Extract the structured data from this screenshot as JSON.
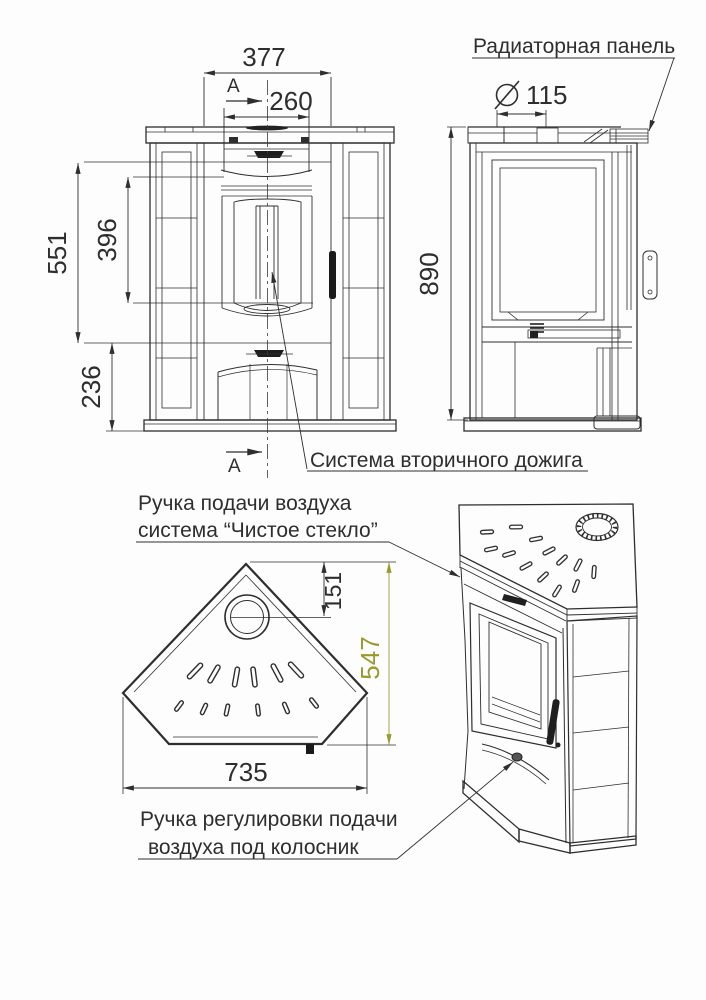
{
  "section_marker": "А",
  "front_view": {
    "dim_width_top": "377",
    "dim_width_opening": "260",
    "dim_height_upper": "551",
    "dim_height_glass": "396",
    "dim_height_lower": "236"
  },
  "side_view": {
    "dim_flue_diameter": "115",
    "dim_height_overall": "890"
  },
  "top_view": {
    "dim_tip_to_flue": "151",
    "dim_depth": "547",
    "dim_width": "735"
  },
  "callouts": {
    "radiator_panel": "Радиаторная панель",
    "secondary_afterburn": "Система вторичного дожига",
    "clean_glass_line1": "Ручка подачи воздуха",
    "clean_glass_line2": "система “Чистое стекло”",
    "grate_air_line1": "Ручка регулировки подачи",
    "grate_air_line2": "воздуха под колосник"
  },
  "colors": {
    "line": "#2e2e2e",
    "depth_dim": "#99992e"
  }
}
